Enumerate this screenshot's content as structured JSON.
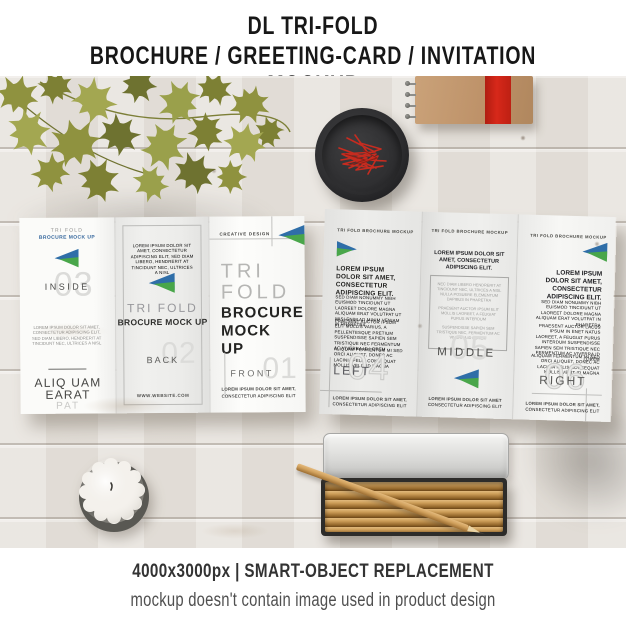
{
  "header": {
    "line1": "DL TRI-FOLD",
    "line2": "BROCHURE / GREETING-CARD / INVITATION MOCKUP"
  },
  "footer": {
    "line1": "4000x3000px | SMART-OBJECT REPLACEMENT",
    "line2": "mockup doesn't contain image used in product design"
  },
  "colors": {
    "logo_blue": "#2f6ea8",
    "logo_green": "#49a64a",
    "paperclip_red": "#c62c20",
    "notebook_band_red": "#d7281a",
    "kicker_blue": "#38699e"
  },
  "icons": {
    "logo": "triangle-play-icon",
    "bowl": "paperclip-bowl",
    "plant": "maple-leaves"
  },
  "brochure_left": {
    "inside": {
      "kicker1": "TRI FOLD",
      "kicker2": "BROCURE MOCK UP",
      "label": "INSIDE",
      "number": "03",
      "box_text": "LOREM IPSUM DOLOR SIT AMET, CONSECTETUR ADIPISCING ELIT, SED DIAM LIBERO, HENDRERIT AT TINCIDUNT NEC, ULTRICES A NISL",
      "name1": "ALIQ UAM",
      "name2": "EARAT",
      "name3": "PAT"
    },
    "back": {
      "intro": "LOREM IPSUM DOLOR SIT AMET, CONSECTETUR ADIPISCING ELIT, SED DIAM LIBERO, HENDRERIT AT TINCIDUNT NEC, ULTRICES A NISL",
      "title1": "TRI FOLD",
      "title2": "BROCURE MOCK UP",
      "label": "BACK",
      "number": "02",
      "website": "WWW.WEBSITE.COM"
    },
    "front": {
      "tagline": "CREATIVE DESIGN",
      "light1": "TRI",
      "light2": "FOLD",
      "bold1": "BROCURE",
      "bold2": "MOCK",
      "bold3": "UP",
      "label": "FRONT",
      "number": "01",
      "footer_bold": "LOREM IPSUM DOLOR SIT AMET,",
      "footer_light": "CONSECTETUR ADIPISCING ELIT"
    }
  },
  "brochure_right": {
    "left": {
      "kicker": "TRI FOLD BROCHURE MOCKUP",
      "heading": "LOREM IPSUM DOLOR SIT AMET, CONSECTETUR ADIPISCING ELIT.",
      "para1": "SED DIAM NONUMMY NIBH EUISMOD TINCIDUNT UT LAOREET DOLORE MAGNA ALIQUAM ERAT VOLUTPAT UT WISI ENIM AD MINIM VENIAM IN PHARETRA",
      "para2": "PRAESENT AUCTOR IPSUM ELIT MOLLIS VARIUS, A PELLENTESQUE PRETIUM SUSPENDISSE SAPIEN SEM TRISTIQUE NEC FERMENTUM AC VIVERRA ID LOREM",
      "para3": "ALIQUAM FERMENTUM MI SED ORCI ALIQUET, DONEC AC LACINIA FELIS CONSEQUAT MOLLIS VELIT ID MAGNA",
      "label": "LEFT",
      "number": "04",
      "footer_bold": "LOREM IPSUM DOLOR SIT AMET,",
      "footer_light": "CONSECTETUR ADIPISCING ELIT"
    },
    "middle": {
      "kicker": "TRI FOLD BROCHURE MOCKUP",
      "heading": "LOREM IPSUM DOLOR SIT AMET, CONSECTETUR ADIPISCING ELIT.",
      "box1": "NEC DIAM LIBERO HENDRERIT AT TINCIDUNT NEC, ULTRICES A NISL NULLA POSUERE ELEMENTUM DAPIBUS IN PHARETRA",
      "box2": "PRAESENT AUCTOR IPSUM ELIT MOLLIS LAOREET, A FEUGIAT PURUS INTERDUM",
      "box3": "SUSPENDISSE SAPIEN SEM TRISTIQUE NEC, FERMENTUM AC VIVERRA ID LOREM",
      "label": "MIDDLE",
      "number": "05",
      "footer_bold": "LOREM IPSUM DOLOR SIT AMET",
      "footer_light": "CONSECTETUR ADIPISCING ELIT"
    },
    "right": {
      "kicker": "TRI FOLD BROCHURE MOCKUP",
      "heading": "LOREM IPSUM DOLOR SIT AMET, CONSECTETUR ADIPISCING ELIT.",
      "para1": "SED DIAM NONUMMY NIBH EUISMOD TINCIDUNT UT LAOREET DOLORE MAGNA ALIQUAM ERAT VOLUTPAT IN PHARETRA",
      "para2": "PRAESENT AUCTOR LACUS IPSUM IN ENET NATUS LAOREET, A FEUGIAT PURUS INTERDUM SUSPENDISSE SAPIEN SEM TRISTIQUE NEC FERMENTUM AC VIVERRA ID LOREM",
      "para3": "ALIQUAM FERMENTUM MI SED ORCI ALIQUET, DONEC AC LACINIA FELIS CONSEQUAT MOLLIS VELIT ID MAGNA",
      "label": "RIGHT",
      "number": "06",
      "footer_bold": "LOREM IPSUM DOLOR SIT AMET,",
      "footer_light": "CONSECTETUR ADIPISCING ELIT"
    }
  }
}
